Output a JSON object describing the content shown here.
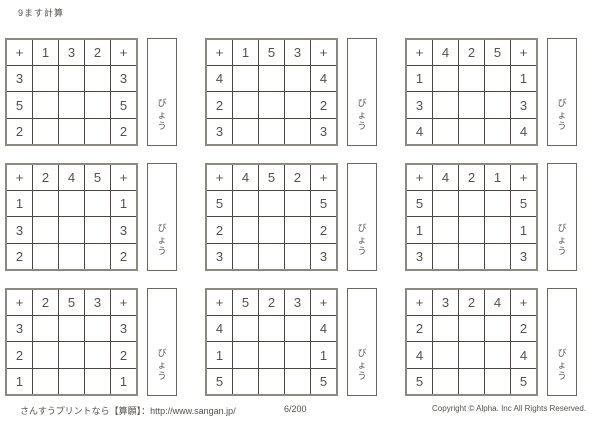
{
  "page": {
    "title": "9ます計算",
    "operator": "+",
    "seconds_label": "びょう",
    "footer": {
      "left": "さんすうプリントなら【算願】：http://www.sangan.jp/",
      "page_number": "6/200",
      "copyright": "Copyright © Alpha. Inc All Rights Reserved."
    },
    "colors": {
      "ink": "#55504a",
      "line_thin": "#4c4641",
      "line_thick": "#8d8880",
      "background": "#ffffff"
    }
  },
  "puzzles": [
    {
      "top": [
        "1",
        "3",
        "2"
      ],
      "left": [
        "3",
        "5",
        "2"
      ],
      "right": [
        "3",
        "5",
        "2"
      ]
    },
    {
      "top": [
        "1",
        "5",
        "3"
      ],
      "left": [
        "4",
        "2",
        "3"
      ],
      "right": [
        "4",
        "2",
        "3"
      ]
    },
    {
      "top": [
        "4",
        "2",
        "5"
      ],
      "left": [
        "1",
        "3",
        "4"
      ],
      "right": [
        "1",
        "3",
        "4"
      ]
    },
    {
      "top": [
        "2",
        "4",
        "5"
      ],
      "left": [
        "1",
        "3",
        "2"
      ],
      "right": [
        "1",
        "3",
        "2"
      ]
    },
    {
      "top": [
        "4",
        "5",
        "2"
      ],
      "left": [
        "5",
        "2",
        "3"
      ],
      "right": [
        "5",
        "2",
        "3"
      ]
    },
    {
      "top": [
        "4",
        "2",
        "1"
      ],
      "left": [
        "5",
        "1",
        "3"
      ],
      "right": [
        "5",
        "1",
        "3"
      ]
    },
    {
      "top": [
        "2",
        "5",
        "3"
      ],
      "left": [
        "3",
        "2",
        "1"
      ],
      "right": [
        "3",
        "2",
        "1"
      ]
    },
    {
      "top": [
        "5",
        "2",
        "3"
      ],
      "left": [
        "4",
        "1",
        "5"
      ],
      "right": [
        "4",
        "1",
        "5"
      ]
    },
    {
      "top": [
        "3",
        "2",
        "4"
      ],
      "left": [
        "2",
        "4",
        "5"
      ],
      "right": [
        "2",
        "4",
        "5"
      ]
    }
  ]
}
